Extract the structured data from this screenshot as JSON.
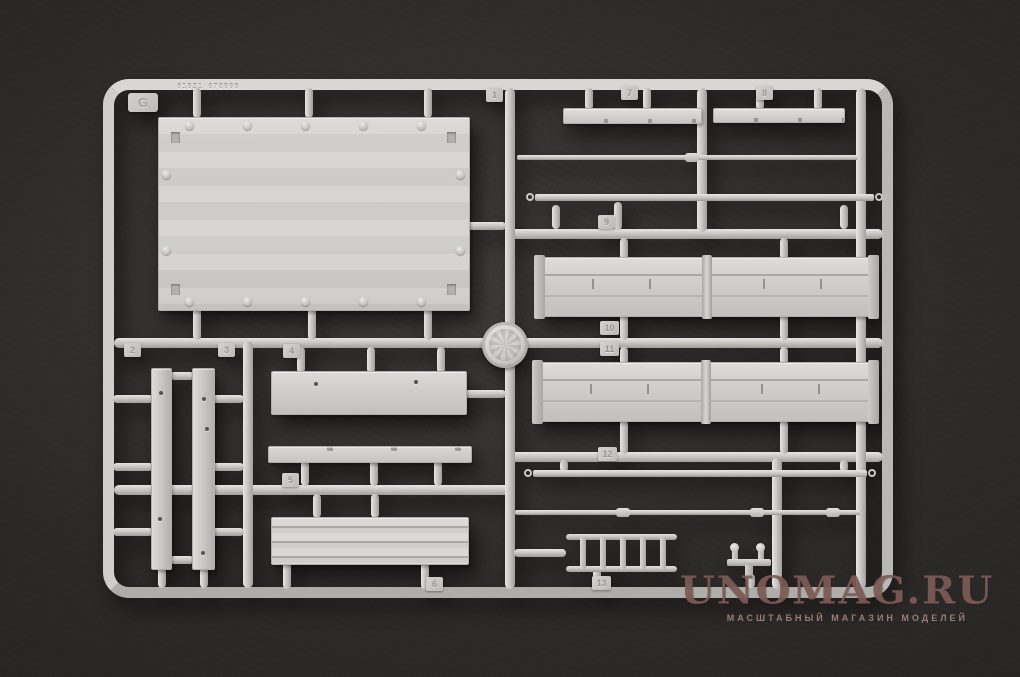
{
  "photo": {
    "background_color": "#2b2928",
    "plastic_color": "#c9c8c4"
  },
  "sprue": {
    "mold_code": "01021 070000",
    "tags": [
      {
        "label": "G"
      },
      {
        "label": "1"
      },
      {
        "label": "2"
      },
      {
        "label": "3"
      },
      {
        "label": "4"
      },
      {
        "label": "5"
      },
      {
        "label": "6"
      },
      {
        "label": "7"
      },
      {
        "label": "8"
      },
      {
        "label": "9"
      },
      {
        "label": "10"
      },
      {
        "label": "11"
      },
      {
        "label": "12"
      },
      {
        "label": "13"
      }
    ]
  },
  "watermark": {
    "title": "UNOMAG.RU",
    "subtitle": "МАСШТАБНЫЙ МАГАЗИН МОДЕЛЕЙ",
    "title_color": "#7c5a55",
    "subtitle_color": "#ab8680"
  }
}
